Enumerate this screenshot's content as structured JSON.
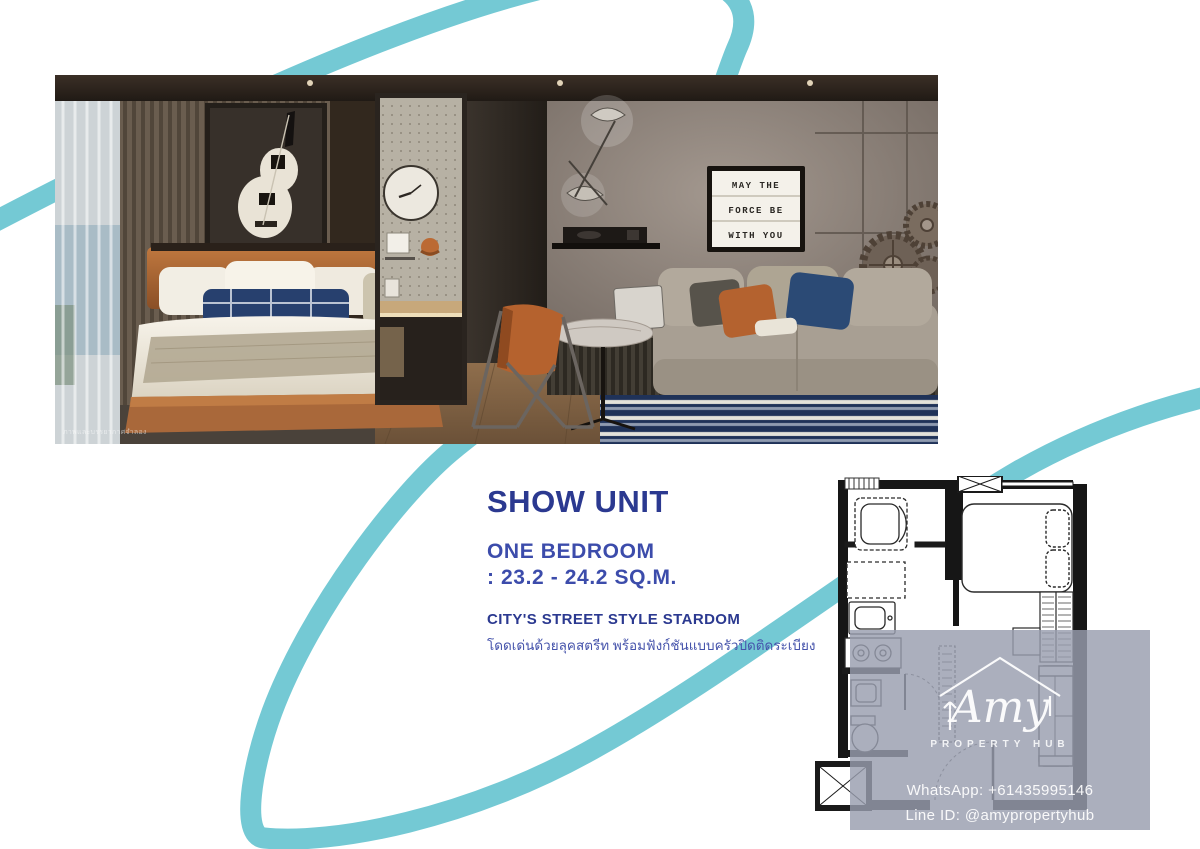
{
  "page": {
    "accent_teal": "#74c9d4",
    "navy": "#2b3990",
    "indigo": "#3c4cab",
    "background": "#ffffff"
  },
  "photo": {
    "caption": "ภาพและบรรยากาศจำลอง",
    "lightbox_sign": {
      "line1": "MAY THE",
      "line2": "FORCE BE",
      "line3": "WITH YOU"
    }
  },
  "details": {
    "title": "SHOW UNIT",
    "unit_type": "ONE BEDROOM",
    "size_range": ": 23.2 - 24.2 SQ.M.",
    "tagline": "CITY'S STREET STYLE STARDOM",
    "tagline_thai": "โดดเด่นด้วยลุคสตรีท พร้อมฟังก์ชันแบบครัวปิดติดระเบียง"
  },
  "watermark": {
    "brand": "Amy",
    "brand_sub": "PROPERTY HUB",
    "whatsapp": "WhatsApp: +61435995146",
    "line_id": "Line ID: @amypropertyhub"
  }
}
